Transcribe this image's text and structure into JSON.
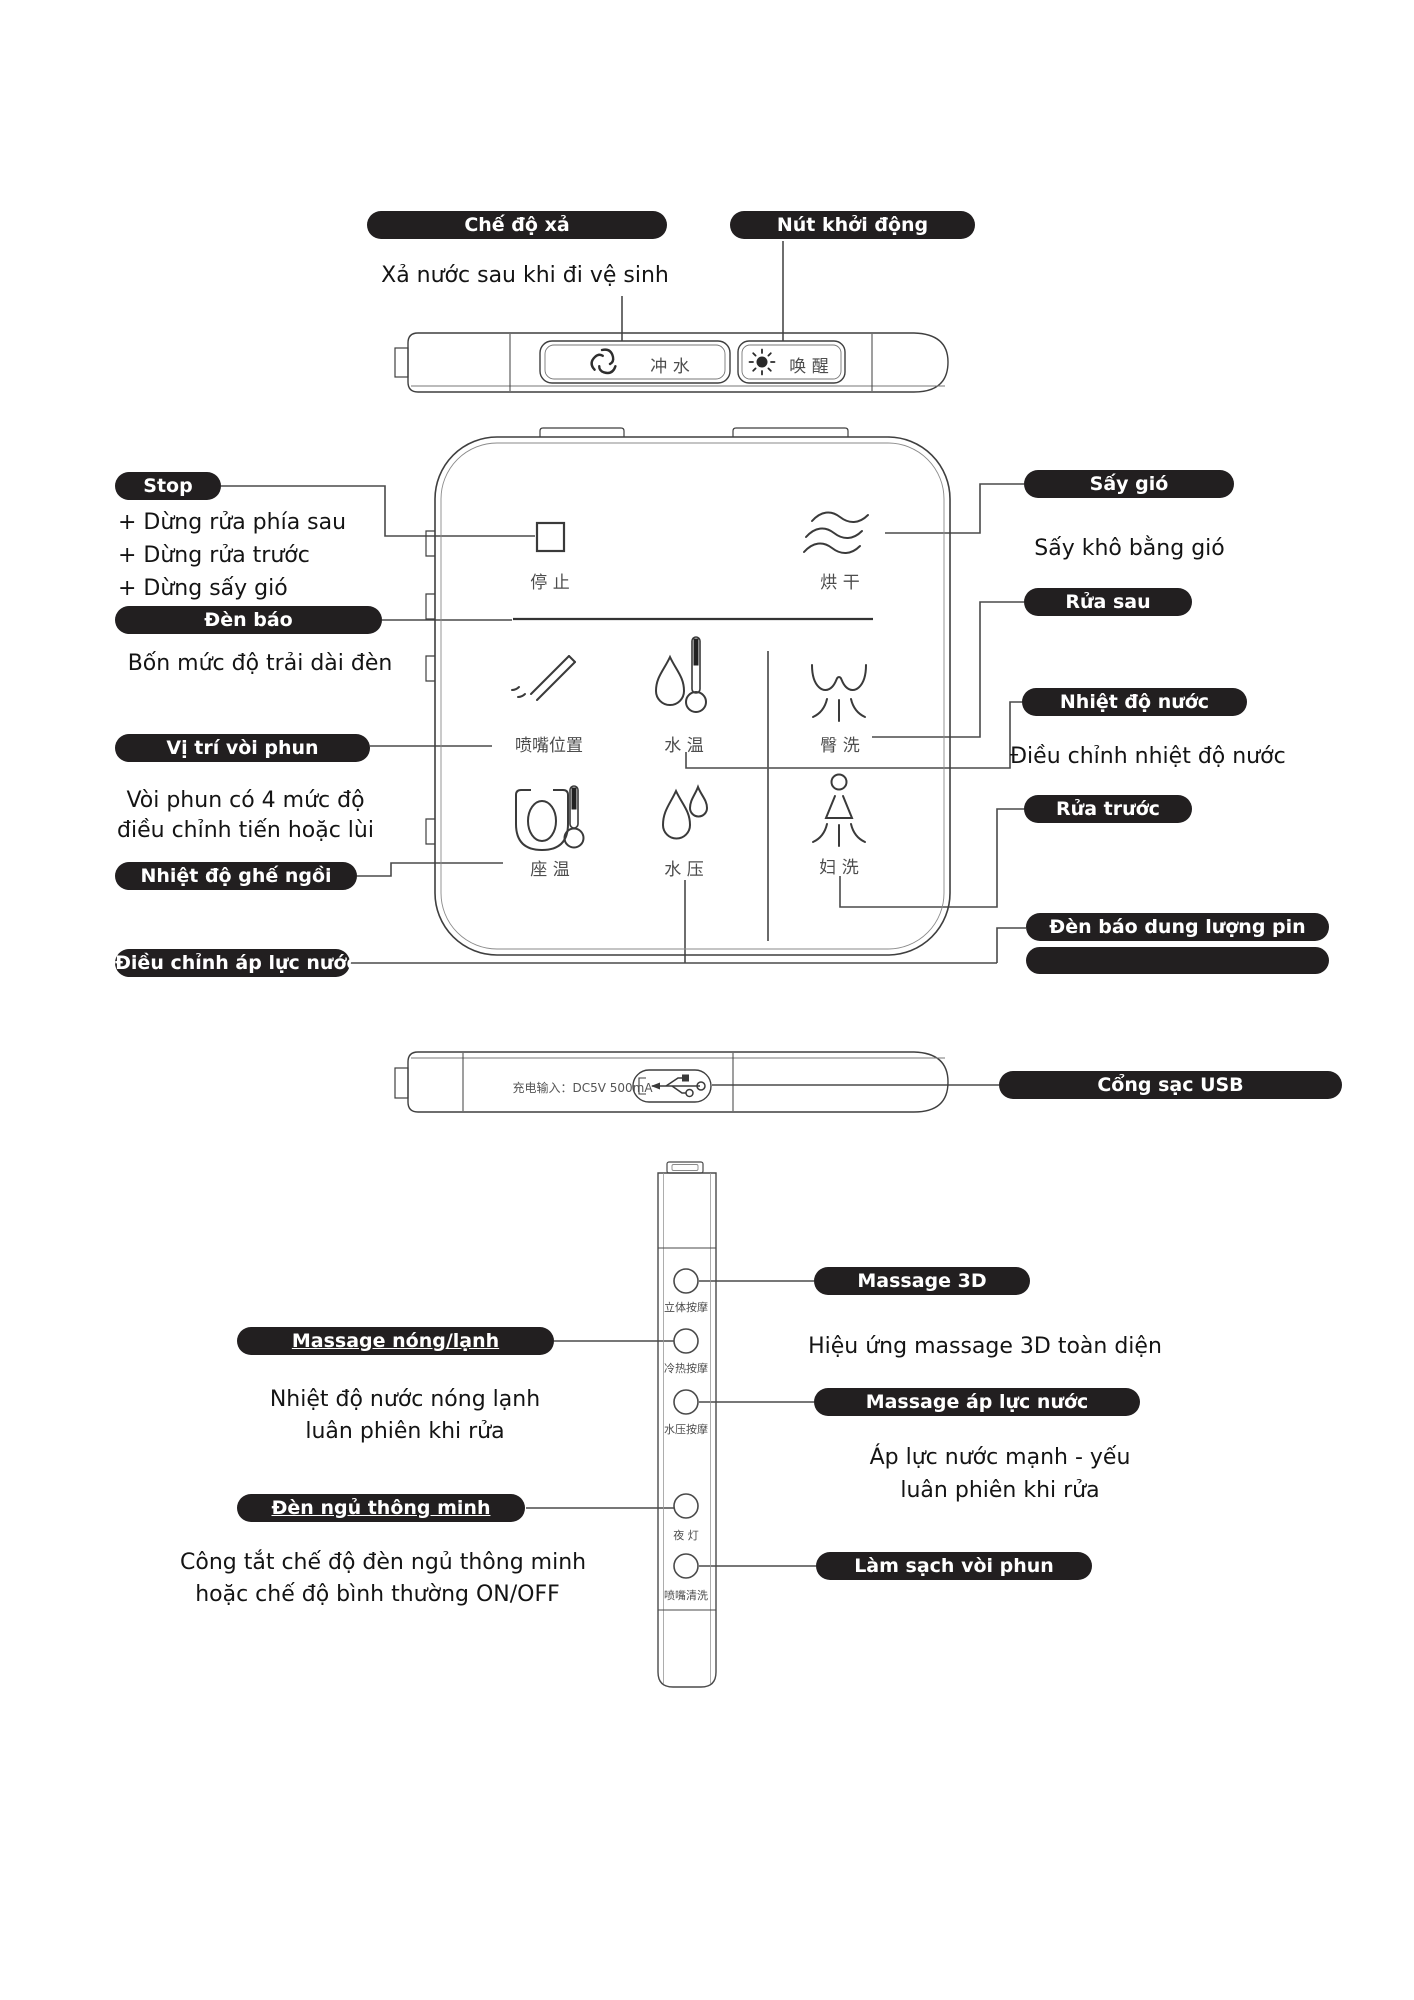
{
  "colors": {
    "badge_bg": "#221f20",
    "badge_text": "#ffffff",
    "line": "#4a4a4a",
    "cjk_text": "#4d4d4d"
  },
  "top": {
    "flush_mode_badge": "Chế độ xả",
    "start_button_badge": "Nút khởi động",
    "flush_description": "Xả nước sau khi đi vệ sinh",
    "flush_button_label": "冲 水",
    "wake_button_label": "唤 醒"
  },
  "remote": {
    "stop_label": "停 止",
    "dry_label": "烘 干",
    "nozzle_position_label": "喷嘴位置",
    "water_temp_label": "水 温",
    "rear_wash_label": "臀 洗",
    "seat_temp_label": "座 温",
    "water_pressure_label": "水 压",
    "feminine_wash_label": "妇 洗"
  },
  "left_callouts": {
    "stop_badge": "Stop",
    "stop_line1": "+ Dừng rửa phía sau",
    "stop_line2": "+ Dừng rửa trước",
    "stop_line3": "+ Dừng sấy gió",
    "indicator_badge": "Đèn báo",
    "indicator_description": "Bốn mức độ trải dài đèn",
    "nozzle_badge": "Vị trí vòi phun",
    "nozzle_description_line1": "Vòi phun có 4 mức độ",
    "nozzle_description_line2": "điều chỉnh tiến hoặc lùi",
    "seat_temp_badge": "Nhiệt độ ghế ngồi",
    "water_pressure_badge": "Điều chỉnh áp lực nước"
  },
  "right_callouts": {
    "dry_badge": "Sấy gió",
    "dry_description": "Sấy khô bằng gió",
    "rear_wash_badge": "Rửa sau",
    "water_temp_badge": "Nhiệt độ nước",
    "water_temp_description": "Điều chỉnh nhiệt độ nước",
    "front_wash_badge": "Rửa trước",
    "battery_badge": "Đèn báo dung lượng pin",
    "usb_badge": "Cổng sạc USB"
  },
  "usb_panel": {
    "charge_input_label": "充电输入：DC5V 500mA"
  },
  "side_panel": {
    "button1_label": "立体按摩",
    "button2_label": "冷热按摩",
    "button3_label": "水压按摩",
    "button4_label": "夜 灯",
    "button5_label": "喷嘴清洗",
    "massage_3d_badge": "Massage 3D",
    "massage_3d_description": "Hiệu ứng massage 3D toàn diện",
    "hot_cold_badge": "Massage nóng/lạnh",
    "hot_cold_description_line1": "Nhiệt độ nước nóng lạnh",
    "hot_cold_description_line2": "luân phiên khi rửa",
    "pressure_massage_badge": "Massage áp lực nước",
    "pressure_massage_description_line1": "Áp lực nước mạnh - yếu",
    "pressure_massage_description_line2": "luân phiên khi rửa",
    "night_light_badge": "Đèn ngủ thông minh",
    "night_light_description_line1": "Công tắt chế độ đèn ngủ thông minh",
    "night_light_description_line2": "hoặc chế độ bình thường ON/OFF",
    "nozzle_clean_badge": "Làm sạch vòi phun"
  }
}
